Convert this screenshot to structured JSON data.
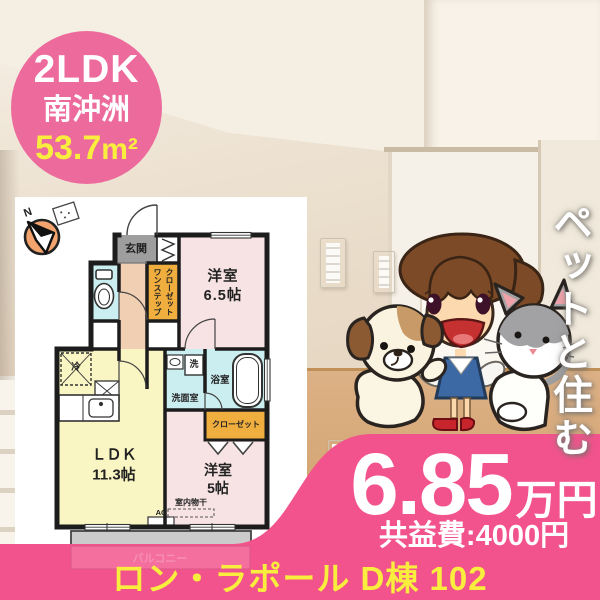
{
  "badge": {
    "layout": "2LDK",
    "location": "南沖洲",
    "area_value": "53.7",
    "area_unit": "m²"
  },
  "catchphrase": "ペットと住む",
  "floorplan": {
    "compass": "N",
    "genkan": "玄関",
    "one_step_closet": "ワンステップ\nクローゼット",
    "bedroom1": "洋室\n6.5帖",
    "laundry": "洗",
    "washroom": "洗面室",
    "bathroom": "浴室",
    "closet": "クローゼット",
    "fridge": "冷",
    "ldk": "ＬＤＫ\n11.3帖",
    "bedroom2": "洋室\n5帖",
    "indoor_drying": "室内物干",
    "ac": "AC",
    "balcony": "バルコニー"
  },
  "price": {
    "rent": "6.85",
    "unit": "万円",
    "fee": "共益費:4000円"
  },
  "footer": {
    "property": "ロン・ラポール D棟 102"
  },
  "colors": {
    "accent_pink": "#F2538C",
    "badge_pink": "#ED6B9C",
    "highlight_yellow": "#F9ED3E",
    "plan_ldk_yellow": "#FAF6C3",
    "plan_bedroom_pink": "#F7E3E3",
    "plan_wet_cyan": "#CBEEF1",
    "plan_closet_orange": "#EFAE3E",
    "plan_genkan_gray": "#9E9E9E",
    "plan_hall_peach": "#F1CFB2"
  }
}
